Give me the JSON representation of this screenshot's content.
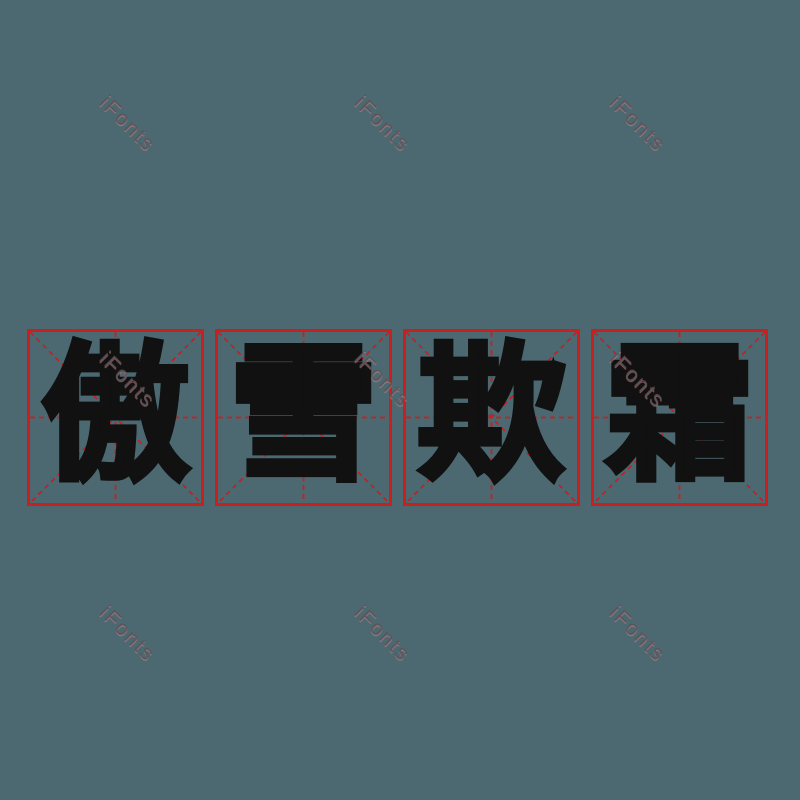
{
  "background_color": "#4c6971",
  "phrase": {
    "text": "傲雪欺霜",
    "language": "zh",
    "meaning_note": "four-character idiom rendered one character per practice grid"
  },
  "grid": {
    "style": "mi-zi-ge calligraphy practice square",
    "line_color": "#c91f1f",
    "glyph_color": "#111111",
    "cells": [
      {
        "char": "傲"
      },
      {
        "char": "雪"
      },
      {
        "char": "欺"
      },
      {
        "char": "霜"
      }
    ]
  },
  "watermark": {
    "text": "iFonts",
    "color": "#585458",
    "rotation_deg": 45,
    "count": 9
  }
}
